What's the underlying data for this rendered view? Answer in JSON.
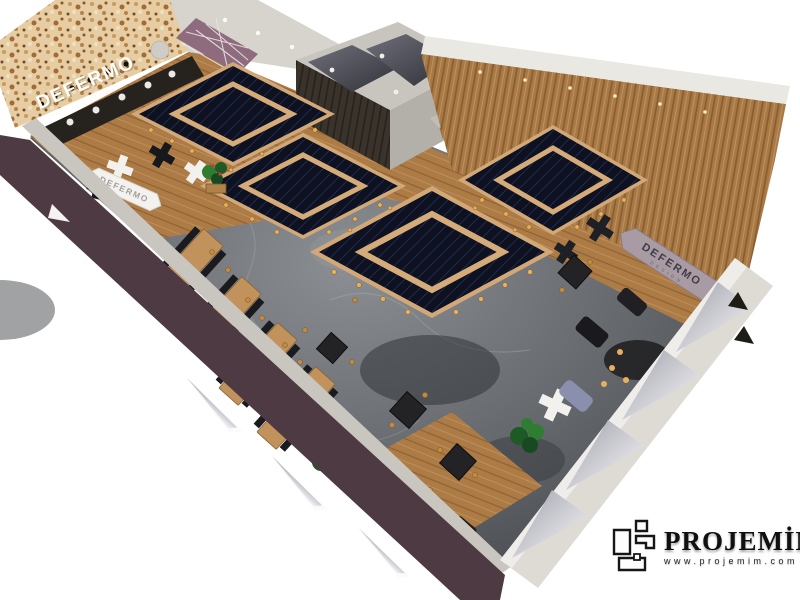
{
  "render": {
    "description": "Aerial 3D perspective render of a restaurant interior",
    "signs": {
      "stone_wall": {
        "title": "DEFERMO",
        "subtitle": "DESIGN"
      },
      "left_banner": {
        "title": "DEFERMO"
      },
      "right_banner": {
        "title": "DEFERMO",
        "subtitle": "DESIGN"
      }
    },
    "features": {
      "diamond_ceiling_canopies": 4,
      "back_rooms": 2,
      "style": "navy diamond canopies with wood trim, marble floor, wood slat walls, pendant bulb lights"
    },
    "palette": {
      "canopy_navy": "#0d1120",
      "wood_trim": "#d2a878",
      "wood_wall": "#a87945",
      "marble_floor": "#63666a",
      "maroon_wall": "#4e3a42",
      "stone_wall": "#e6cda4",
      "white_wall": "#dedbd5",
      "brass": "#c08b45",
      "plant_green": "#2e7d32"
    }
  },
  "watermark": {
    "brand": "PROJEMİM",
    "website": "www.projemim.com"
  }
}
